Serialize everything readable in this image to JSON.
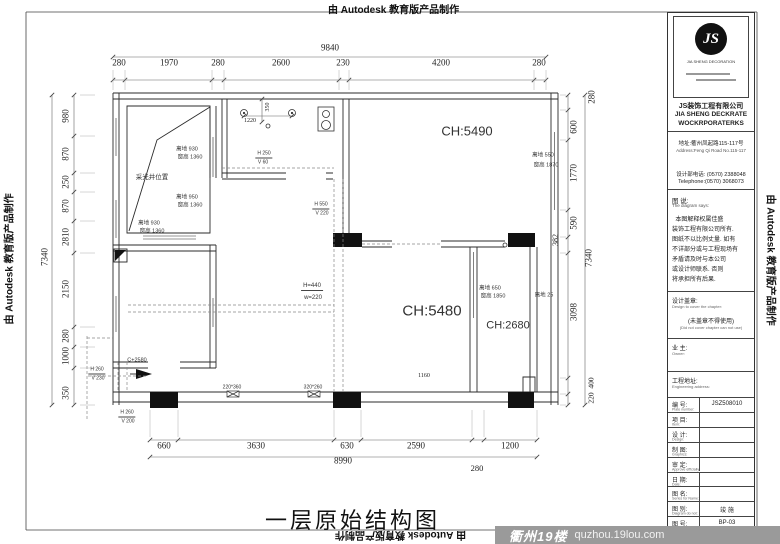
{
  "banner": {
    "text": "由 Autodesk 教育版产品制作"
  },
  "title": "一层原始结构图",
  "watermark": {
    "brand": "衢州19楼",
    "site": "quzhou.19lou.com"
  },
  "title_block": {
    "logo_monogram": "JS",
    "logo_brand": "JIA SHENG DECORATION",
    "company_cn": "JS装饰工程有限公司",
    "company_en_1": "JIA SHENG DECKRATE",
    "company_en_2": "WOCKRPORATERKS",
    "address_cn": "地址:衢州凤起路115-117号",
    "address_en": "Address:Feng Qi Road No.115-117",
    "phone_cn": "设计部电话: (0570) 2388048",
    "phone_en": "Telephone:(0570) 3068073",
    "notes_title_cn": "图 说:",
    "notes_title_en": "The diagram says:",
    "notes_lines": [
      "本图解释权属佳盛",
      "装饰工程有限公司所有.",
      "图纸不以比例丈量. 如有",
      "不详部分或与工程现场有",
      "矛盾请及时与本公司",
      "或设计师联系. 否则",
      "将承担所有后果."
    ],
    "stamp_cn": "设计盖章:",
    "stamp_en": "Design to cover the chapter:",
    "stamp_warning_cn": "(未盖章不得使用)",
    "stamp_warning_en": "(Did not cover chapter can not use)",
    "owner_cn": "业 主:",
    "owner_en": "Owner:",
    "site_cn": "工程地址:",
    "site_en": "Engineering address:",
    "rows": [
      {
        "label": "编 号:",
        "sub": "Plate number:",
        "value": "JSZ508010"
      },
      {
        "label": "项 目:",
        "sub": "Item:",
        "value": ""
      },
      {
        "label": "设 计:",
        "sub": "Design:",
        "value": ""
      },
      {
        "label": "制 图:",
        "sub": "Graphics:",
        "value": ""
      },
      {
        "label": "审 定:",
        "sub": "Approve efficially:",
        "value": ""
      },
      {
        "label": "日 期:",
        "sub": "Date:",
        "value": ""
      },
      {
        "label": "图 名:",
        "sub": "Series for Name:",
        "value": ""
      },
      {
        "label": "图 别:",
        "sub": "Diagram do not:",
        "value": "竣 施"
      },
      {
        "label": "图 号:",
        "sub": "",
        "value": "BP-03"
      }
    ]
  },
  "plan": {
    "labels": [
      {
        "t": "9840",
        "x": 330,
        "y": 48,
        "c": "dim",
        "s": 9
      },
      {
        "t": "280",
        "x": 119,
        "y": 63,
        "c": "dim",
        "s": 9
      },
      {
        "t": "1970",
        "x": 169,
        "y": 63,
        "c": "dim",
        "s": 9
      },
      {
        "t": "280",
        "x": 218,
        "y": 63,
        "c": "dim",
        "s": 9
      },
      {
        "t": "2600",
        "x": 281,
        "y": 63,
        "c": "dim",
        "s": 9
      },
      {
        "t": "230",
        "x": 343,
        "y": 63,
        "c": "dim",
        "s": 9
      },
      {
        "t": "4200",
        "x": 441,
        "y": 63,
        "c": "dim",
        "s": 9
      },
      {
        "t": "280",
        "x": 539,
        "y": 63,
        "c": "dim",
        "s": 9
      },
      {
        "t": "7340",
        "x": 45,
        "y": 257,
        "c": "dim",
        "s": 9,
        "r": -90
      },
      {
        "t": "980",
        "x": 66,
        "y": 116,
        "c": "dim",
        "s": 9,
        "r": -90
      },
      {
        "t": "870",
        "x": 66,
        "y": 154,
        "c": "dim",
        "s": 9,
        "r": -90
      },
      {
        "t": "250",
        "x": 66,
        "y": 182,
        "c": "dim",
        "s": 9,
        "r": -90
      },
      {
        "t": "870",
        "x": 66,
        "y": 206,
        "c": "dim",
        "s": 9,
        "r": -90
      },
      {
        "t": "2810",
        "x": 66,
        "y": 237,
        "c": "dim",
        "s": 9,
        "r": -90
      },
      {
        "t": "2150",
        "x": 66,
        "y": 289,
        "c": "dim",
        "s": 9,
        "r": -90
      },
      {
        "t": "280",
        "x": 66,
        "y": 336,
        "c": "dim",
        "s": 9,
        "r": -90
      },
      {
        "t": "1000",
        "x": 66,
        "y": 356,
        "c": "dim",
        "s": 9,
        "r": -90
      },
      {
        "t": "350",
        "x": 66,
        "y": 393,
        "c": "dim",
        "s": 9,
        "r": -90
      },
      {
        "t": "280",
        "x": 592,
        "y": 97,
        "c": "dim",
        "s": 9,
        "r": -90
      },
      {
        "t": "600",
        "x": 574,
        "y": 127,
        "c": "dim",
        "s": 9,
        "r": -90
      },
      {
        "t": "1770",
        "x": 574,
        "y": 173,
        "c": "dim",
        "s": 9,
        "r": -90
      },
      {
        "t": "590",
        "x": 574,
        "y": 223,
        "c": "dim",
        "s": 9,
        "r": -90
      },
      {
        "t": "382",
        "x": 556,
        "y": 240,
        "c": "dim",
        "s": 8,
        "r": -90
      },
      {
        "t": "3098",
        "x": 574,
        "y": 312,
        "c": "dim",
        "s": 9,
        "r": -90
      },
      {
        "t": "7340",
        "x": 589,
        "y": 258,
        "c": "dim",
        "s": 9,
        "r": -90
      },
      {
        "t": "400",
        "x": 591,
        "y": 383,
        "c": "dim",
        "s": 7.5,
        "r": -90
      },
      {
        "t": "220",
        "x": 591,
        "y": 398,
        "c": "dim",
        "s": 7.5,
        "r": -90
      },
      {
        "t": "660",
        "x": 164,
        "y": 446,
        "c": "dim",
        "s": 9
      },
      {
        "t": "3630",
        "x": 256,
        "y": 446,
        "c": "dim",
        "s": 9
      },
      {
        "t": "630",
        "x": 347,
        "y": 446,
        "c": "dim",
        "s": 9
      },
      {
        "t": "2590",
        "x": 416,
        "y": 446,
        "c": "dim",
        "s": 9
      },
      {
        "t": "1200",
        "x": 510,
        "y": 446,
        "c": "dim",
        "s": 9
      },
      {
        "t": "8990",
        "x": 343,
        "y": 461,
        "c": "dim",
        "s": 9
      },
      {
        "t": "280",
        "x": 477,
        "y": 468,
        "c": "dim",
        "s": 8.5
      },
      {
        "t": "1220",
        "x": 250,
        "y": 121,
        "c": "dim",
        "s": 6
      },
      {
        "t": "350",
        "x": 268,
        "y": 107,
        "c": "dim",
        "s": 6,
        "r": -90
      },
      {
        "t": "1160",
        "x": 424,
        "y": 376,
        "c": "dim",
        "s": 6
      },
      {
        "t": "采光井位置",
        "x": 152,
        "y": 178,
        "c": "ann",
        "s": 6.5
      },
      {
        "t": "离地 930",
        "x": 187,
        "y": 150,
        "c": "ann",
        "s": 5.5
      },
      {
        "t": "窗高 1360",
        "x": 190,
        "y": 158,
        "c": "ann",
        "s": 5.5
      },
      {
        "t": "离地 950",
        "x": 187,
        "y": 198,
        "c": "ann",
        "s": 5.5
      },
      {
        "t": "窗高 1360",
        "x": 190,
        "y": 206,
        "c": "ann",
        "s": 5.5
      },
      {
        "t": "离地 930",
        "x": 149,
        "y": 224,
        "c": "ann",
        "s": 5.5
      },
      {
        "t": "窗高 1360",
        "x": 152,
        "y": 232,
        "c": "ann",
        "s": 5.5
      },
      {
        "t": "离地 550",
        "x": 543,
        "y": 156,
        "c": "ann",
        "s": 5.5
      },
      {
        "t": "窗高 1870",
        "x": 546,
        "y": 166,
        "c": "ann",
        "s": 5.5
      },
      {
        "t": "离地 650",
        "x": 490,
        "y": 289,
        "c": "ann",
        "s": 5.5
      },
      {
        "t": "窗高 1850",
        "x": 493,
        "y": 297,
        "c": "ann",
        "s": 5.5
      },
      {
        "t": "离地 25",
        "x": 544,
        "y": 296,
        "c": "ann",
        "s": 5.5
      },
      {
        "t": "C+2580",
        "x": 137,
        "y": 361,
        "c": "ann",
        "s": 5.5
      },
      {
        "t": "H 260",
        "x": 97,
        "y": 371,
        "c": "ann",
        "s": 5,
        "u": 1
      },
      {
        "t": "V 230",
        "x": 98,
        "y": 379,
        "c": "ann",
        "s": 5
      },
      {
        "t": "H 260",
        "x": 127,
        "y": 414,
        "c": "ann",
        "s": 5,
        "u": 1
      },
      {
        "t": "V 200",
        "x": 128,
        "y": 422,
        "c": "ann",
        "s": 5
      },
      {
        "t": "H 250",
        "x": 264,
        "y": 155,
        "c": "ann",
        "s": 5,
        "u": 1
      },
      {
        "t": "V 60",
        "x": 263,
        "y": 163,
        "c": "ann",
        "s": 5
      },
      {
        "t": "H 550",
        "x": 321,
        "y": 206,
        "c": "ann",
        "s": 5,
        "u": 1
      },
      {
        "t": "V 220",
        "x": 322,
        "y": 214,
        "c": "ann",
        "s": 5
      },
      {
        "t": "H=440",
        "x": 312,
        "y": 287,
        "c": "ann",
        "s": 6,
        "u": 1
      },
      {
        "t": "w=220",
        "x": 313,
        "y": 298,
        "c": "ann",
        "s": 6
      },
      {
        "t": "220*360",
        "x": 232,
        "y": 388,
        "c": "ann",
        "s": 5
      },
      {
        "t": "320*260",
        "x": 313,
        "y": 388,
        "c": "ann",
        "s": 5
      },
      {
        "t": "CH:5490",
        "x": 467,
        "y": 131,
        "c": "ann",
        "s": 13
      },
      {
        "t": "CH:5480",
        "x": 432,
        "y": 311,
        "c": "ann",
        "s": 15
      },
      {
        "t": "CH:2680",
        "x": 508,
        "y": 326,
        "c": "ann",
        "s": 11
      }
    ]
  }
}
